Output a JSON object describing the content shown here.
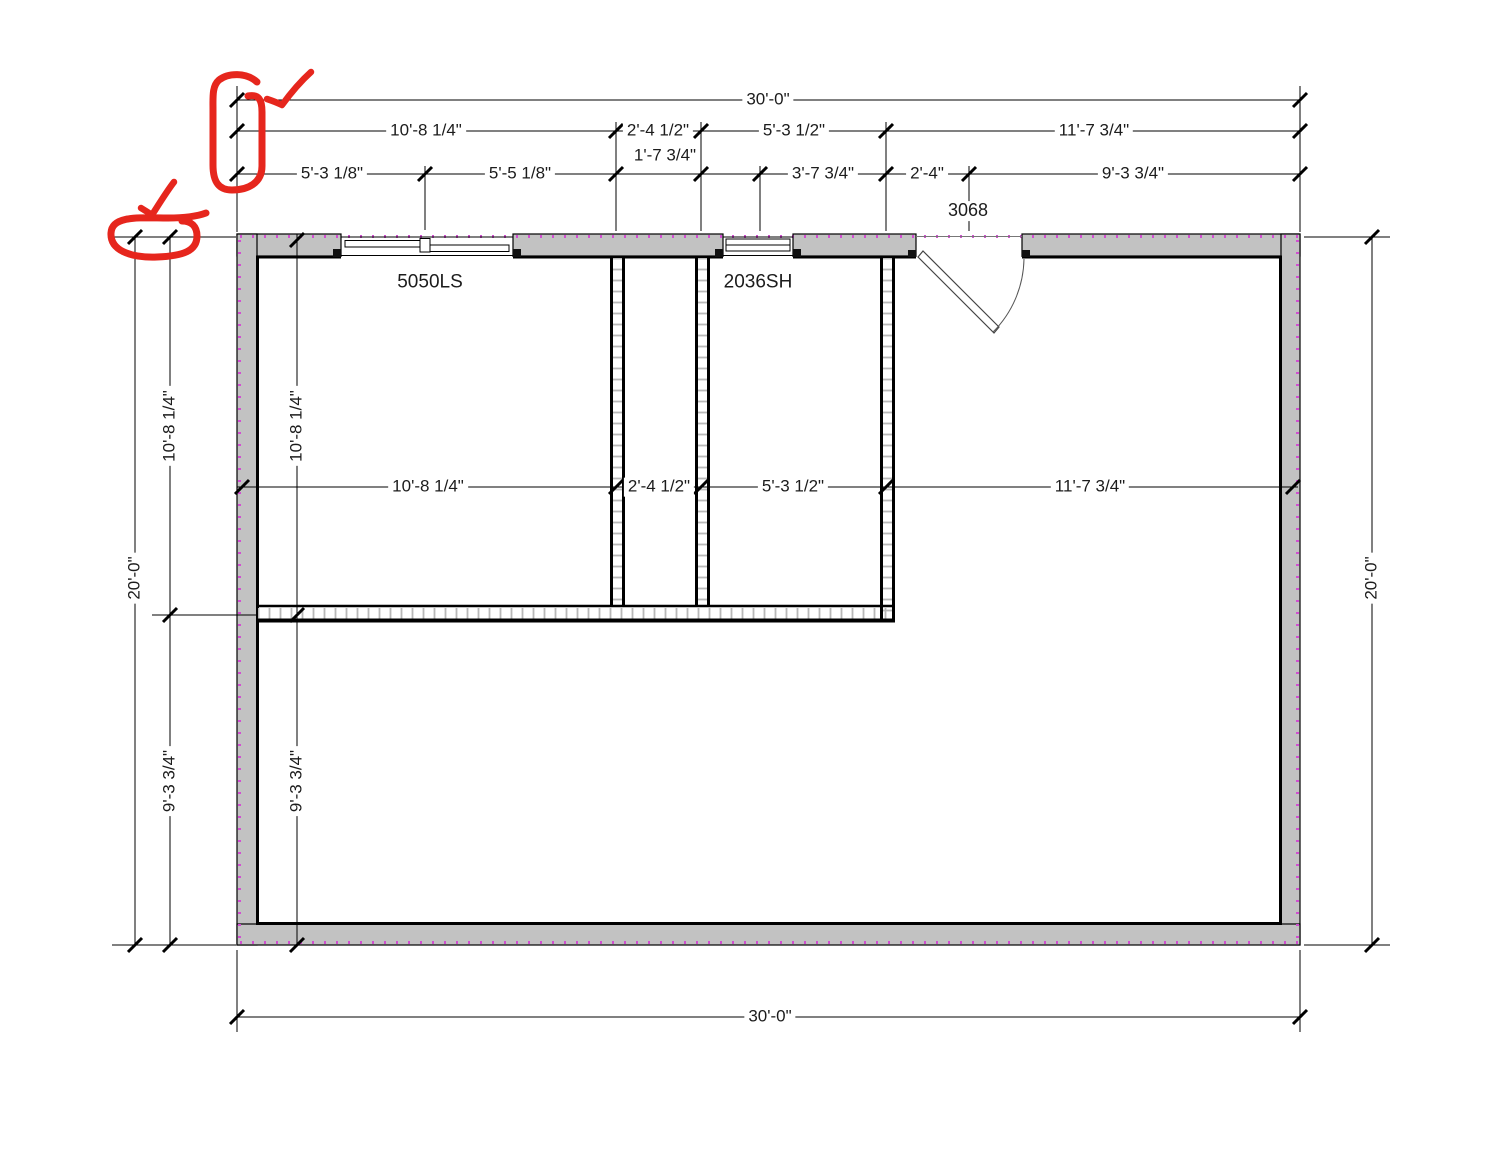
{
  "drawing": {
    "kind": "floor-plan",
    "wall_fill": "#c2c2c2",
    "line_color": "#000000",
    "exterior_hatch_color": "#d14fd1",
    "annotation_color": "#e6261d"
  },
  "dims": {
    "top_row1": {
      "overall": "30'-0\""
    },
    "top_row2": {
      "a": "10'-8 1/4\"",
      "b": "2'-4 1/2\"",
      "c": "5'-3 1/2\"",
      "d": "11'-7 3/4\""
    },
    "top_row3": {
      "a": "5'-3 1/8\"",
      "b": "5'-5 1/8\"",
      "c": "1'-7 3/4\"",
      "d": "3'-7 3/4\"",
      "e": "2'-4\"",
      "f": "9'-3 3/4\""
    },
    "mid_row": {
      "a": "10'-8 1/4\"",
      "b": "2'-4 1/2\"",
      "c": "5'-3 1/2\"",
      "d": "11'-7 3/4\""
    },
    "left_outer": "20'-0\"",
    "left_upper": "10'-8 1/4\"",
    "left_lower": "9'-3 3/4\"",
    "left_inner_upper": "10'-8 1/4\"",
    "left_inner_lower": "9'-3 3/4\"",
    "right_outer": "20'-0\"",
    "bottom_overall": "30'-0\""
  },
  "tags": {
    "door": "3068",
    "window_large": "5050LS",
    "window_small": "2036SH"
  },
  "annotations": {
    "items": [
      "circle-around-top-left-ticks",
      "checkmark-top-left",
      "circle-around-left-ticks",
      "checkmark-left"
    ]
  }
}
